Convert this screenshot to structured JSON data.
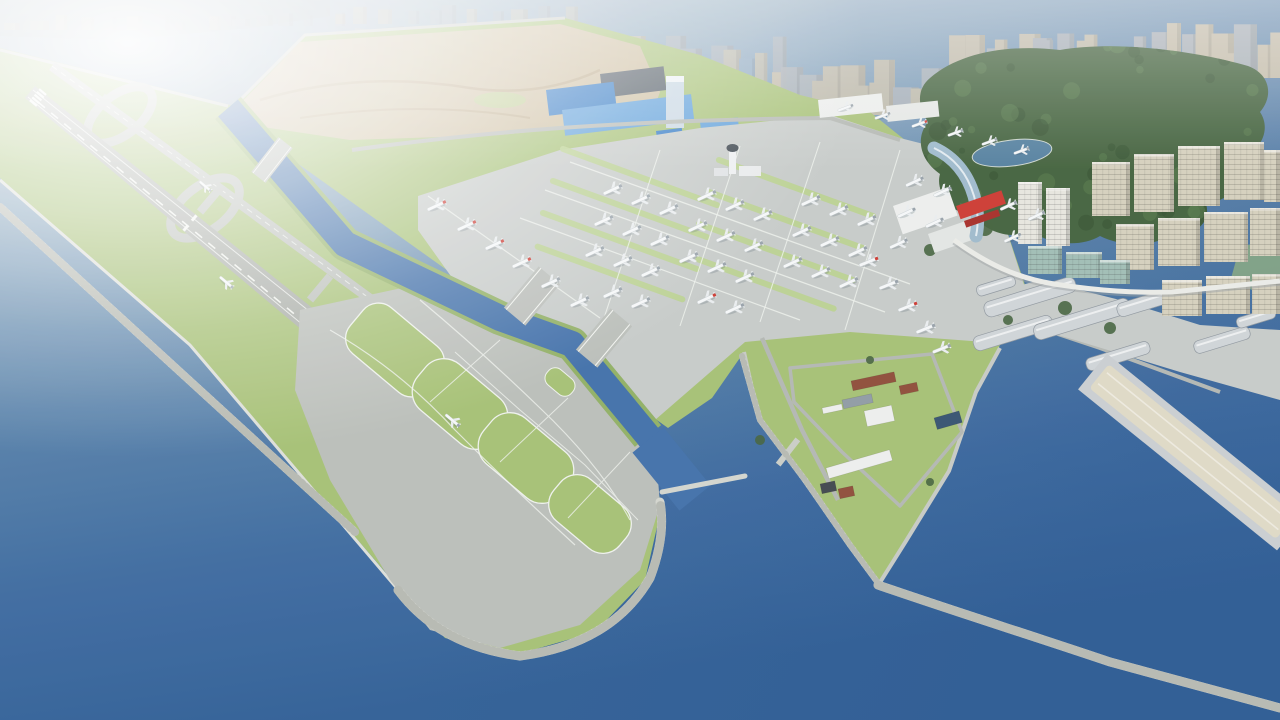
{
  "scene": {
    "description": "3D aerial rendering of a coastal airport built on reclaimed land: an offshore runway island with looping taxiways and rock breakwaters, a water channel crossed by taxiway bridges, aircraft parking aprons with red-tailed and white airliners, a control tower, a terminal with a red gate truss and curved glass hall, blue-roofed logistics buildings, a dirt construction area, a dense city skyline in haze, a forested hill with a pond, beige residential blocks, harbor warehouses, a long pier and breakwaters in deep blue water.",
    "type": "architectural-visualization",
    "visible_text": ""
  },
  "colors": {
    "waterTop": "#aabbc8",
    "waterUpper": "#7f9fba",
    "waterMid": "#557fa8",
    "waterDeep": "#3a689e",
    "waterBottom": "#2d5c94",
    "channelWater": "#3f6ea8",
    "grass": "#a4bf72",
    "grassDark": "#8fae62",
    "grassLight": "#b8d08c",
    "pavement": "#b9bdb8",
    "apron": "#c6cac8",
    "runwaySurface": "#a6aaa4",
    "markingWhite": "#f3f5f1",
    "breakwater": "#d2d4cd",
    "dirt": "#ccbd9e",
    "dirtTrack": "#b09a78",
    "forest": "#41603b",
    "forestDark": "#324e2e",
    "forestLight": "#567a4b",
    "pond": "#527e9e",
    "cityBeige": "#c6bca6",
    "cityGray": "#aab0b6",
    "cityBlue": "#8fa9c0",
    "blueRoof": "#2f77c4",
    "blueRoofLight": "#5b9dd9",
    "towerBlue": "#c7d6e2",
    "parkingDark": "#4e5862",
    "redAccent": "#cc3830",
    "redDark": "#a62c26",
    "terminalGlass": "#9db9cb",
    "residBeige": "#d4cfbc",
    "residWhite": "#e6e5de",
    "glassTeal": "#9fbcb4",
    "warehouseRoof": "#ced3d6",
    "pierSand": "#ded8c4",
    "brownBldg": "#8d4a36",
    "grayRoof": "#8e99a3",
    "darkContainer": "#3e444a",
    "solarBlue": "#33506e",
    "white": "#eceeec",
    "tailGray": "#96a0a8"
  },
  "city_clusters": [
    {
      "x0": 4,
      "x1": 205,
      "baseY": 30,
      "hmin": 6,
      "hmax": 16,
      "wmin": 10,
      "wmax": 22,
      "count": 9,
      "palette": [
        "cityGray",
        "cityBeige"
      ],
      "opacity": 0.45,
      "seed": 11
    },
    {
      "x0": 215,
      "x1": 330,
      "baseY": 26,
      "hmin": 6,
      "hmax": 14,
      "wmin": 8,
      "wmax": 18,
      "count": 6,
      "palette": [
        "cityGray"
      ],
      "opacity": 0.4,
      "seed": 12
    },
    {
      "x0": 335,
      "x1": 560,
      "baseY": 24,
      "hmin": 8,
      "hmax": 20,
      "wmin": 9,
      "wmax": 20,
      "count": 11,
      "palette": [
        "cityBeige",
        "cityGray"
      ],
      "opacity": 0.5,
      "seed": 13
    },
    {
      "x0": 565,
      "x1": 770,
      "baseY": 100,
      "hmin": 28,
      "hmax": 68,
      "wmin": 12,
      "wmax": 24,
      "count": 16,
      "palette": [
        "cityBeige",
        "cityGray",
        "cityBlue"
      ],
      "opacity": 0.75,
      "seed": 14
    },
    {
      "x0": 770,
      "x1": 960,
      "baseY": 115,
      "hmin": 26,
      "hmax": 58,
      "wmin": 12,
      "wmax": 26,
      "count": 15,
      "palette": [
        "cityBeige",
        "cityBeige",
        "cityGray"
      ],
      "opacity": 0.85,
      "seed": 15
    },
    {
      "x0": 955,
      "x1": 1135,
      "baseY": 82,
      "hmin": 20,
      "hmax": 50,
      "wmin": 12,
      "wmax": 24,
      "count": 13,
      "palette": [
        "cityBeige",
        "cityGray"
      ],
      "opacity": 0.9,
      "seed": 16
    },
    {
      "x0": 1135,
      "x1": 1282,
      "baseY": 78,
      "hmin": 22,
      "hmax": 56,
      "wmin": 12,
      "wmax": 26,
      "count": 11,
      "palette": [
        "cityBeige",
        "cityBeige",
        "cityGray"
      ],
      "opacity": 0.95,
      "seed": 17
    }
  ],
  "aircraft": [
    [
      436,
      206,
      -25,
      1,
      1
    ],
    [
      466,
      226,
      -25,
      1,
      1
    ],
    [
      494,
      245,
      -25,
      1,
      1
    ],
    [
      521,
      263,
      -25,
      1,
      1
    ],
    [
      550,
      283,
      -25,
      1,
      0
    ],
    [
      579,
      302,
      -25,
      1,
      0
    ],
    [
      612,
      190,
      -25,
      1,
      0
    ],
    [
      640,
      200,
      -25,
      1,
      0
    ],
    [
      668,
      210,
      -25,
      1,
      0
    ],
    [
      603,
      221,
      -25,
      1,
      0
    ],
    [
      631,
      231,
      -25,
      1,
      0
    ],
    [
      659,
      241,
      -25,
      1,
      0
    ],
    [
      594,
      252,
      -25,
      1,
      0
    ],
    [
      622,
      262,
      -25,
      1,
      0
    ],
    [
      650,
      272,
      -25,
      1,
      0
    ],
    [
      612,
      293,
      -25,
      1,
      0
    ],
    [
      640,
      303,
      -25,
      1,
      0
    ],
    [
      706,
      196,
      -25,
      1,
      0
    ],
    [
      734,
      206,
      -25,
      1,
      0
    ],
    [
      762,
      216,
      -25,
      1,
      0
    ],
    [
      697,
      227,
      -25,
      1,
      0
    ],
    [
      725,
      237,
      -25,
      1,
      0
    ],
    [
      753,
      247,
      -25,
      1,
      0
    ],
    [
      688,
      258,
      -25,
      1,
      0
    ],
    [
      716,
      268,
      -25,
      1,
      0
    ],
    [
      744,
      278,
      -25,
      1,
      0
    ],
    [
      706,
      299,
      -25,
      1,
      1
    ],
    [
      734,
      309,
      -25,
      1,
      0
    ],
    [
      810,
      201,
      -25,
      1,
      0
    ],
    [
      838,
      211,
      -25,
      1,
      0
    ],
    [
      866,
      221,
      -25,
      1,
      0
    ],
    [
      801,
      232,
      -25,
      1,
      0
    ],
    [
      829,
      242,
      -25,
      1,
      0
    ],
    [
      857,
      252,
      -25,
      1,
      0
    ],
    [
      792,
      263,
      -25,
      1,
      0
    ],
    [
      820,
      273,
      -25,
      1,
      0
    ],
    [
      848,
      283,
      -25,
      1,
      0
    ],
    [
      914,
      182,
      -25,
      0.95,
      0
    ],
    [
      942,
      192,
      -25,
      0.95,
      0
    ],
    [
      906,
      213,
      -25,
      0.95,
      0
    ],
    [
      934,
      223,
      -25,
      0.95,
      0
    ],
    [
      898,
      244,
      -25,
      0.95,
      0
    ],
    [
      1008,
      206,
      -25,
      0.9,
      0
    ],
    [
      1036,
      216,
      -25,
      0.9,
      0
    ],
    [
      1012,
      238,
      -25,
      0.9,
      0
    ],
    [
      868,
      262,
      -22,
      1,
      1
    ],
    [
      888,
      285,
      -22,
      1,
      0
    ],
    [
      907,
      307,
      -22,
      1,
      1
    ],
    [
      925,
      329,
      -22,
      1,
      0
    ],
    [
      941,
      349,
      -22,
      0.95,
      0
    ],
    [
      845,
      108,
      -20,
      0.8,
      0
    ],
    [
      882,
      116,
      -20,
      0.8,
      0
    ],
    [
      919,
      124,
      -20,
      0.8,
      1
    ],
    [
      955,
      133,
      -20,
      0.8,
      0
    ],
    [
      989,
      142,
      -20,
      0.8,
      0
    ],
    [
      1021,
      151,
      -20,
      0.8,
      0
    ],
    [
      205,
      186,
      40,
      0.75,
      0
    ],
    [
      226,
      282,
      40,
      0.85,
      0
    ],
    [
      452,
      420,
      40,
      0.9,
      0
    ]
  ],
  "apron_strips": [
    [
      640,
      177,
      170
    ],
    [
      630,
      209,
      170
    ],
    [
      620,
      241,
      170
    ],
    [
      610,
      273,
      160
    ],
    [
      796,
      188,
      170
    ],
    [
      786,
      220,
      170
    ],
    [
      776,
      252,
      170
    ],
    [
      766,
      284,
      150
    ]
  ],
  "residential": [
    [
      1018,
      182,
      24,
      62,
      "residWhite"
    ],
    [
      1046,
      188,
      24,
      58,
      "residWhite"
    ],
    [
      1092,
      162,
      38,
      54,
      "residBeige"
    ],
    [
      1134,
      154,
      40,
      58,
      "residBeige"
    ],
    [
      1178,
      146,
      42,
      60,
      "residBeige"
    ],
    [
      1224,
      142,
      40,
      58,
      "residBeige"
    ],
    [
      1264,
      150,
      16,
      52,
      "residBeige"
    ],
    [
      1116,
      224,
      38,
      46,
      "residBeige"
    ],
    [
      1158,
      218,
      42,
      48,
      "residBeige"
    ],
    [
      1204,
      212,
      44,
      50,
      "residBeige"
    ],
    [
      1250,
      208,
      30,
      48,
      "residBeige"
    ],
    [
      1162,
      280,
      40,
      36,
      "residBeige"
    ],
    [
      1206,
      276,
      44,
      38,
      "residBeige"
    ],
    [
      1252,
      274,
      28,
      40,
      "residBeige"
    ],
    [
      1028,
      246,
      34,
      28,
      "glassTeal"
    ],
    [
      1066,
      252,
      36,
      26,
      "glassTeal"
    ],
    [
      1100,
      260,
      30,
      24,
      "glassTeal"
    ]
  ],
  "warehouses": [
    [
      996,
      286,
      40,
      11,
      -17
    ],
    [
      1030,
      297,
      95,
      16,
      -17
    ],
    [
      1013,
      333,
      82,
      15,
      -17
    ],
    [
      1082,
      319,
      100,
      16,
      -17
    ],
    [
      1148,
      302,
      64,
      14,
      -17
    ],
    [
      1118,
      356,
      66,
      13,
      -17
    ],
    [
      1222,
      340,
      58,
      13,
      -17
    ],
    [
      1256,
      318,
      40,
      11,
      -17
    ]
  ],
  "peninsula_buildings": [
    [
      851,
      381,
      44,
      10,
      -12,
      "brownBldg"
    ],
    [
      899,
      386,
      18,
      9,
      -12,
      "brownBldg"
    ],
    [
      842,
      400,
      30,
      9,
      -12,
      "grayRoof"
    ],
    [
      864,
      411,
      28,
      16,
      -12,
      "white"
    ],
    [
      822,
      408,
      20,
      6,
      -12,
      "white"
    ],
    [
      826,
      468,
      66,
      11,
      -16,
      "white"
    ],
    [
      820,
      484,
      15,
      10,
      -12,
      "darkContainer"
    ],
    [
      838,
      489,
      15,
      10,
      -12,
      "brownBldg"
    ],
    [
      934,
      418,
      26,
      12,
      -16,
      "solarBlue"
    ]
  ],
  "trees": [
    [
      965,
      195,
      9
    ],
    [
      985,
      228,
      8
    ],
    [
      1000,
      205,
      7
    ],
    [
      1065,
      308,
      7
    ],
    [
      1110,
      328,
      6
    ],
    [
      930,
      250,
      6
    ],
    [
      760,
      440,
      5
    ],
    [
      930,
      482,
      4
    ],
    [
      870,
      360,
      4
    ],
    [
      1008,
      320,
      5
    ]
  ],
  "forest": {
    "seed": 7,
    "dots": 70
  }
}
